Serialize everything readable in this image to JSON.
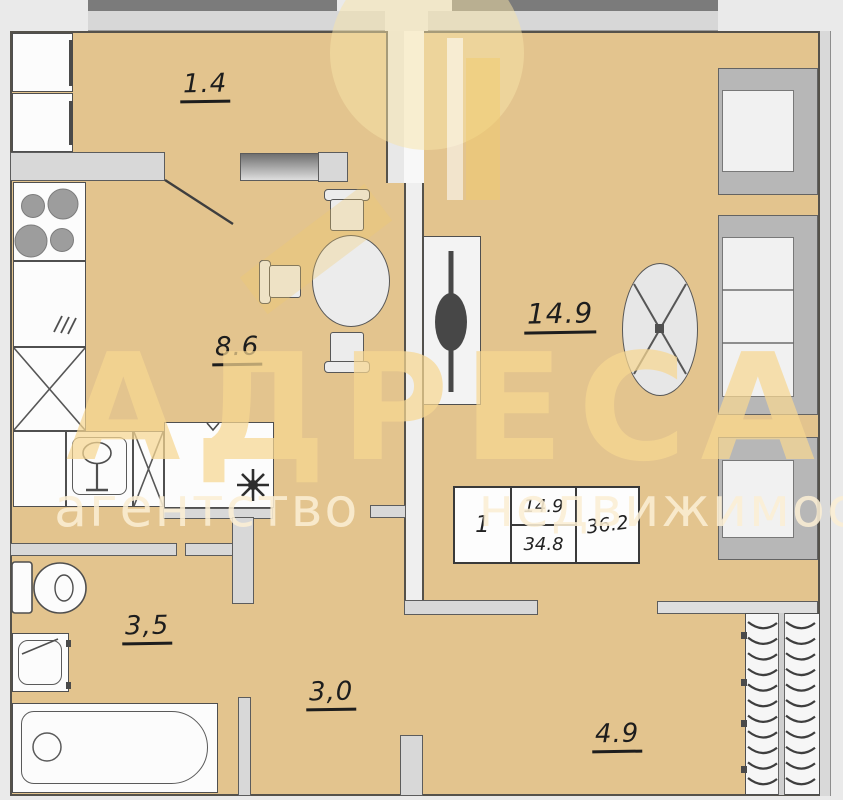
{
  "plan": {
    "rooms": [
      {
        "id": "balcony",
        "area_label": "1.4"
      },
      {
        "id": "kitchen",
        "area_label": "8.6"
      },
      {
        "id": "living-room",
        "area_label": "14.9"
      },
      {
        "id": "bathroom",
        "area_label": "3,5"
      },
      {
        "id": "hallway",
        "area_label": "3,0"
      },
      {
        "id": "wardrobe-room",
        "area_label": "4.9"
      }
    ],
    "stamp": {
      "rooms_count": "1",
      "living_area": "14.9",
      "total_area": "34.8",
      "overall_area": "36.2"
    },
    "watermark": {
      "title": "АДРЕСА",
      "subtitle": "агентство недвижимости"
    },
    "colors": {
      "floor": "#e3c48e",
      "wall": "#d8d8d8",
      "outline": "#55524b",
      "watermark": "#f2cd7f"
    }
  }
}
